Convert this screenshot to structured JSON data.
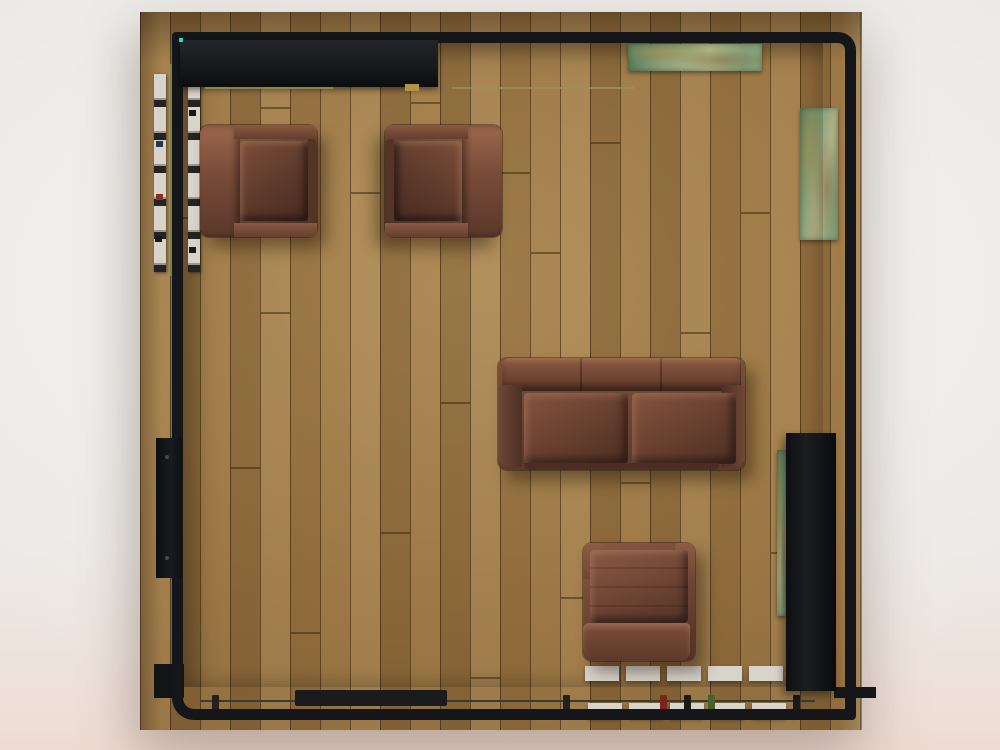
{
  "scene": {
    "view": "top-down architectural 3d render",
    "room": "square living room with vertical oak plank hardwood floor on a light studio background",
    "furniture": [
      {
        "name": "armchair-top-left",
        "material": "brown leather",
        "facing": "right"
      },
      {
        "name": "armchair-top-right",
        "material": "brown leather",
        "facing": "left"
      },
      {
        "name": "loveseat-sofa",
        "material": "brown leather",
        "seats": 2,
        "facing": "down"
      },
      {
        "name": "armchair-bottom",
        "material": "brown leather",
        "facing": "down"
      }
    ],
    "fixtures": [
      "black wall outline with rounded top-right and bottom-left corners",
      "black counter block along top-left wall",
      "green patina bench on top wall",
      "green patina panel on right wall",
      "concrete scaffold strips on left wall",
      "black door panel on left wall",
      "black panel lower-right wall",
      "balustrade railing with concrete balusters along bottom edge",
      "threshold step at bottom-left"
    ]
  },
  "floor": {
    "plank_width_px": 30,
    "plank_joints": [
      [
        30,
        205
      ],
      [
        60,
        120
      ],
      [
        90,
        455
      ],
      [
        120,
        300
      ],
      [
        150,
        620
      ],
      [
        210,
        180
      ],
      [
        240,
        520
      ],
      [
        270,
        90
      ],
      [
        300,
        390
      ],
      [
        330,
        665
      ],
      [
        390,
        240
      ],
      [
        420,
        585
      ],
      [
        450,
        130
      ],
      [
        480,
        470
      ],
      [
        540,
        320
      ],
      [
        570,
        655
      ],
      [
        600,
        200
      ],
      [
        630,
        540
      ],
      [
        660,
        105
      ],
      [
        120,
        95
      ],
      [
        360,
        160
      ],
      [
        510,
        615
      ]
    ]
  },
  "railing": {
    "posts": [
      {
        "x": 212,
        "color": "#23201e"
      },
      {
        "x": 563,
        "color": "#23201e"
      },
      {
        "x": 660,
        "color": "#7e241e"
      },
      {
        "x": 684,
        "color": "#1c1a18"
      },
      {
        "x": 708,
        "color": "#49602f"
      },
      {
        "x": 793,
        "color": "#1c1a18"
      }
    ]
  },
  "specks": [
    {
      "x": 156,
      "y": 141,
      "color": "#2a3350"
    },
    {
      "x": 156,
      "y": 194,
      "color": "#8c2e22"
    },
    {
      "x": 155,
      "y": 236,
      "color": "#181816"
    },
    {
      "x": 189,
      "y": 110,
      "color": "#181816"
    },
    {
      "x": 189,
      "y": 247,
      "color": "#181816"
    }
  ],
  "palette": {
    "background": "#ebe9e6",
    "background_pink_soft": "#eee3dc",
    "background_pink": "#eedcd3",
    "wood_base": "#96713f",
    "wood_light": "#b28c54",
    "wood_dark": "#6e502c",
    "wall_black": "#14161a",
    "leather_mid": "#6a4232",
    "leather_dark": "#45291f",
    "leather_light": "#8f5f46",
    "concrete": "#d8d4cc",
    "patina": "#84a07a",
    "patina_light": "#b0b286",
    "patina_dark": "#587c5c",
    "rail": "#3c3a36",
    "accent_red": "#8c2e22",
    "accent_green": "#4f6a33",
    "accent_teal": "#2fd3c8",
    "accent_gold": "#b3924a"
  }
}
